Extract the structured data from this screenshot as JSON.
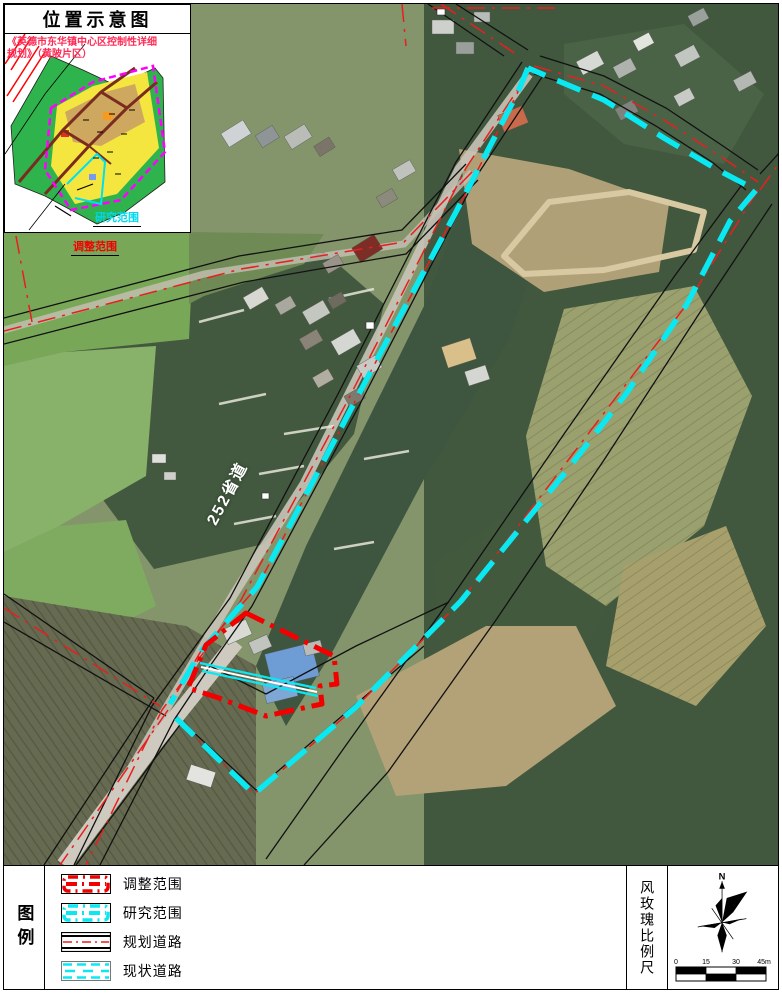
{
  "inset": {
    "title": "位置示意图",
    "plan_note": "《英德市东华镇中心区控制性详细规划》（黄陂片区）",
    "study_label": "研究范围",
    "adjust_label": "调整范围"
  },
  "map": {
    "road_label": "252省道"
  },
  "legend": {
    "title": "图例",
    "items": [
      {
        "label": "调整范围"
      },
      {
        "label": "研究范围"
      },
      {
        "label": "规划道路"
      },
      {
        "label": "现状道路"
      }
    ]
  },
  "compass_panel": {
    "title": "风玫瑰比例尺",
    "north_label": "N",
    "scale_ticks": [
      "0",
      "15",
      "30",
      "45m"
    ]
  },
  "colors": {
    "study_boundary": "#0AE8F2",
    "adjust_boundary": "#F20000",
    "planned_road_center": "#E81F1F",
    "road_edge": "#111111",
    "inset_boundary": "#FF00FF",
    "inset_green": "#2EB34D",
    "inset_yellow": "#F4E63E"
  }
}
